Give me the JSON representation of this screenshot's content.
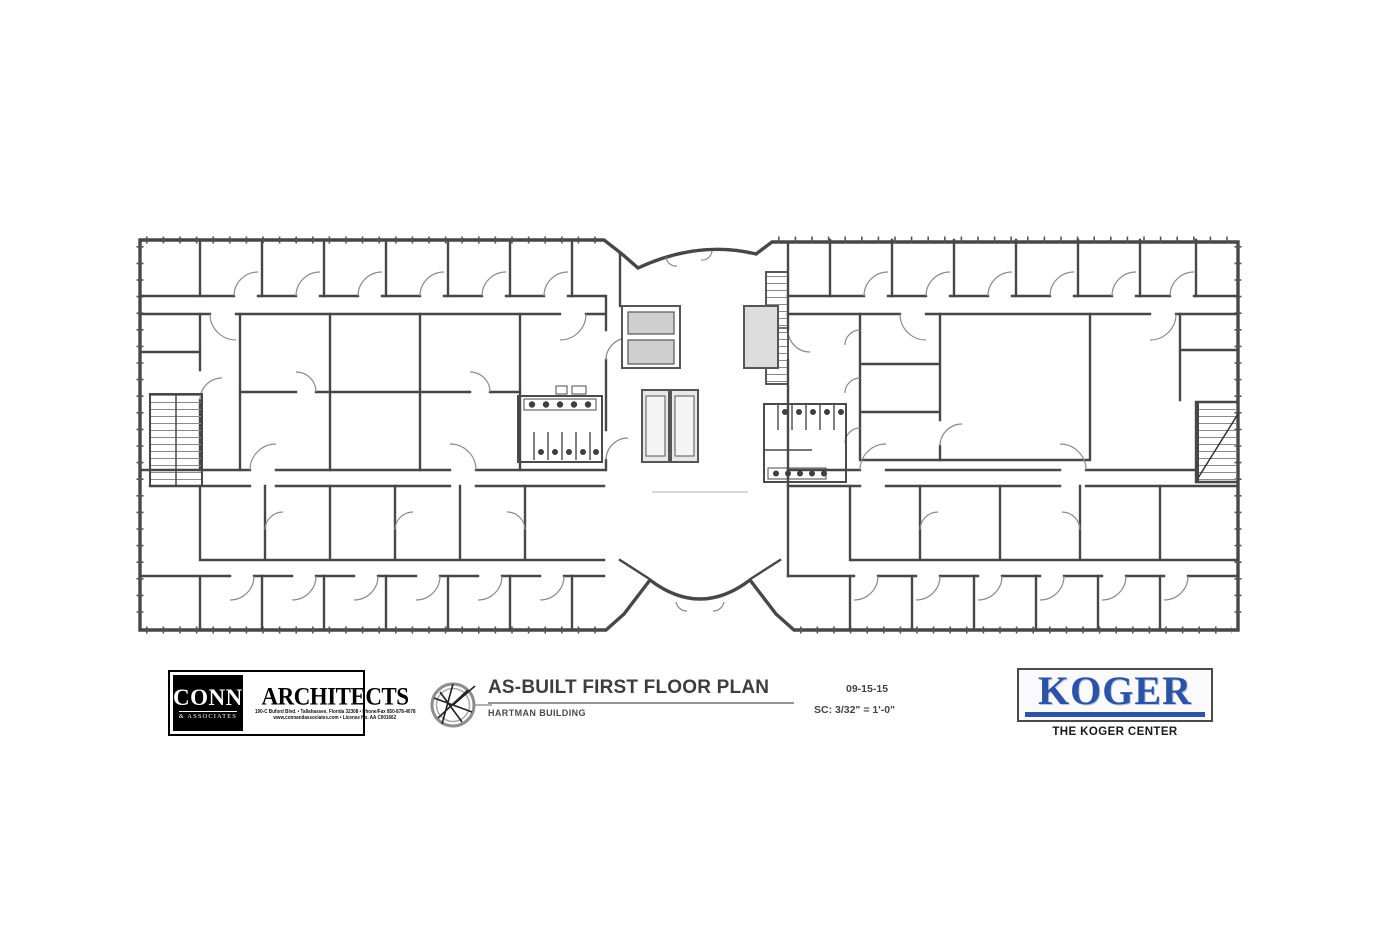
{
  "sheet": {
    "background": "#ffffff",
    "wall_color": "#474747",
    "drawing_description": "As-built first floor plan: two office wings joined by a central elevator core with curved entry vestibules, restrooms and three stairwells"
  },
  "title_block": {
    "title": "AS-BUILT FIRST FLOOR PLAN",
    "building": "HARTMAN BUILDING",
    "date": "09-15-15",
    "scale": "SC: 3/32\" = 1'-0\""
  },
  "architect_block": {
    "name_left_top": "CONN",
    "name_left_bottom": "& ASSOCIATES",
    "name_right": "ARCHITECTS",
    "address_line": "190-C Buford Blvd. • Tallahassee, Florida 32308 • Phone/Fax 850-878-4078",
    "credential_line": "www.connandassociates.com • License No. AA C001662"
  },
  "client_block": {
    "logo_text": "KOGER",
    "caption": "THE KOGER CENTER",
    "brand_blue": "#2d53a5"
  }
}
